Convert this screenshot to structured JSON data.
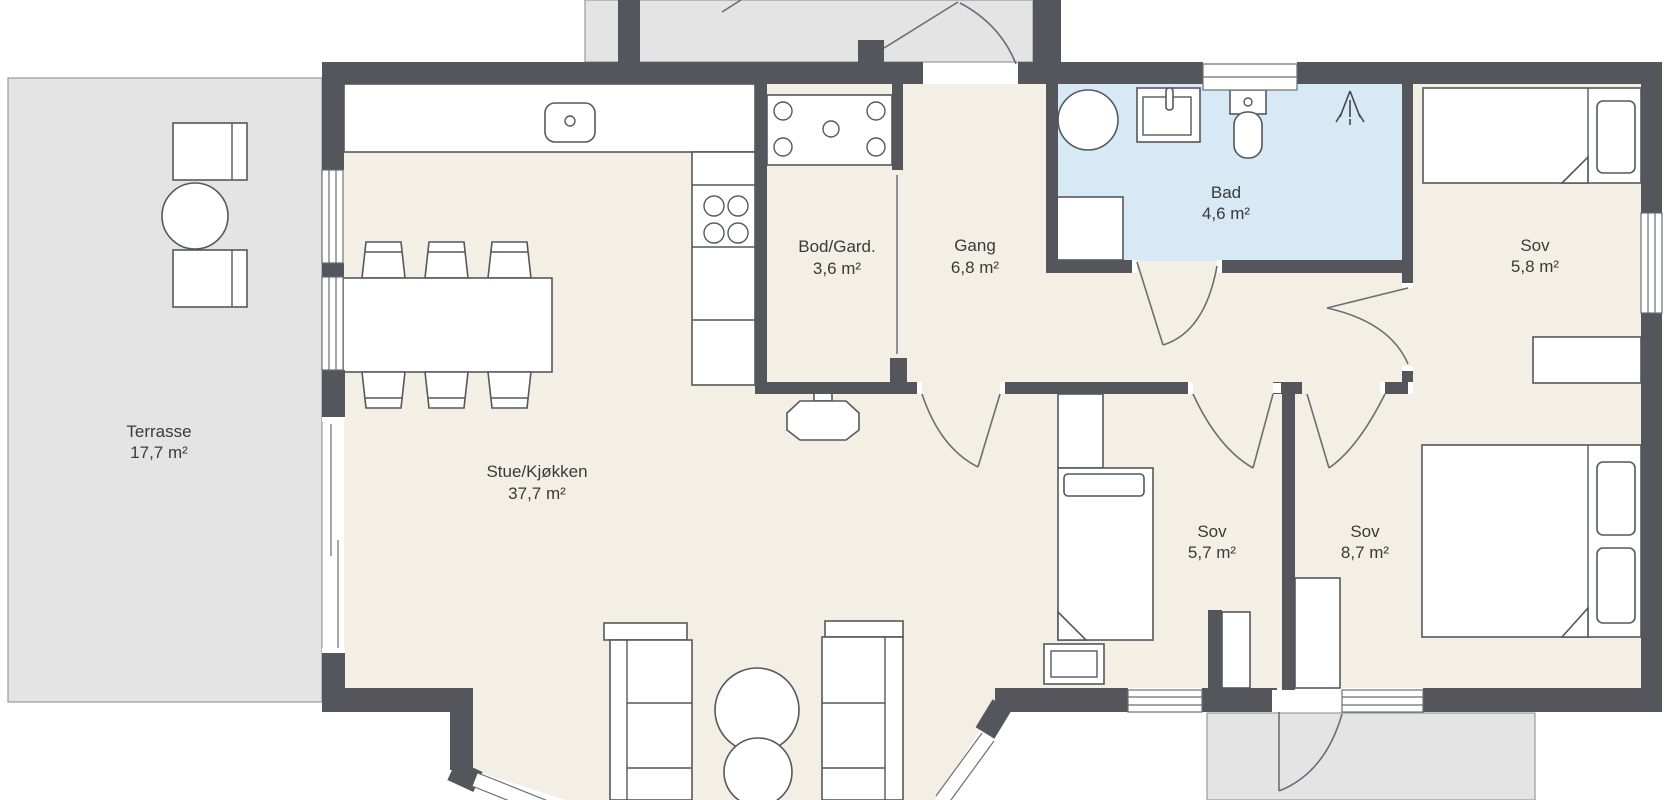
{
  "rooms": {
    "terrasse": {
      "name": "Terrasse",
      "area": "17,7 m²"
    },
    "stue_kjokken": {
      "name": "Stue/Kjøkken",
      "area": "37,7 m²"
    },
    "bod_gard": {
      "name": "Bod/Gard.",
      "area": "3,6 m²"
    },
    "gang": {
      "name": "Gang",
      "area": "6,8 m²"
    },
    "bad": {
      "name": "Bad",
      "area": "4,6 m²"
    },
    "sov_nord": {
      "name": "Sov",
      "area": "5,8 m²"
    },
    "sov_midt": {
      "name": "Sov",
      "area": "5,7 m²"
    },
    "sov_sor": {
      "name": "Sov",
      "area": "8,7 m²"
    }
  },
  "colors": {
    "wall": "#54565b",
    "floor": "#f3efe4",
    "wet_room_floor": "#d6e9f5",
    "outdoor_area": "#e4e4e4",
    "furniture_outline": "#55585c",
    "text": "#3a3a3a"
  },
  "symbols": [
    "kitchen-sink-icon",
    "cooktop-icon",
    "dining-table-icon",
    "wood-stove-icon",
    "washing-machine-icon",
    "bathroom-sink-icon",
    "toilet-icon",
    "shower-icon",
    "single-bed-icon",
    "double-bed-icon",
    "wardrobe-icon",
    "shelf-unit-icon",
    "pouf-icon",
    "terrace-table-icon",
    "terrace-chair-icon",
    "door-swing-icon",
    "window-icon",
    "sliding-door-icon"
  ]
}
